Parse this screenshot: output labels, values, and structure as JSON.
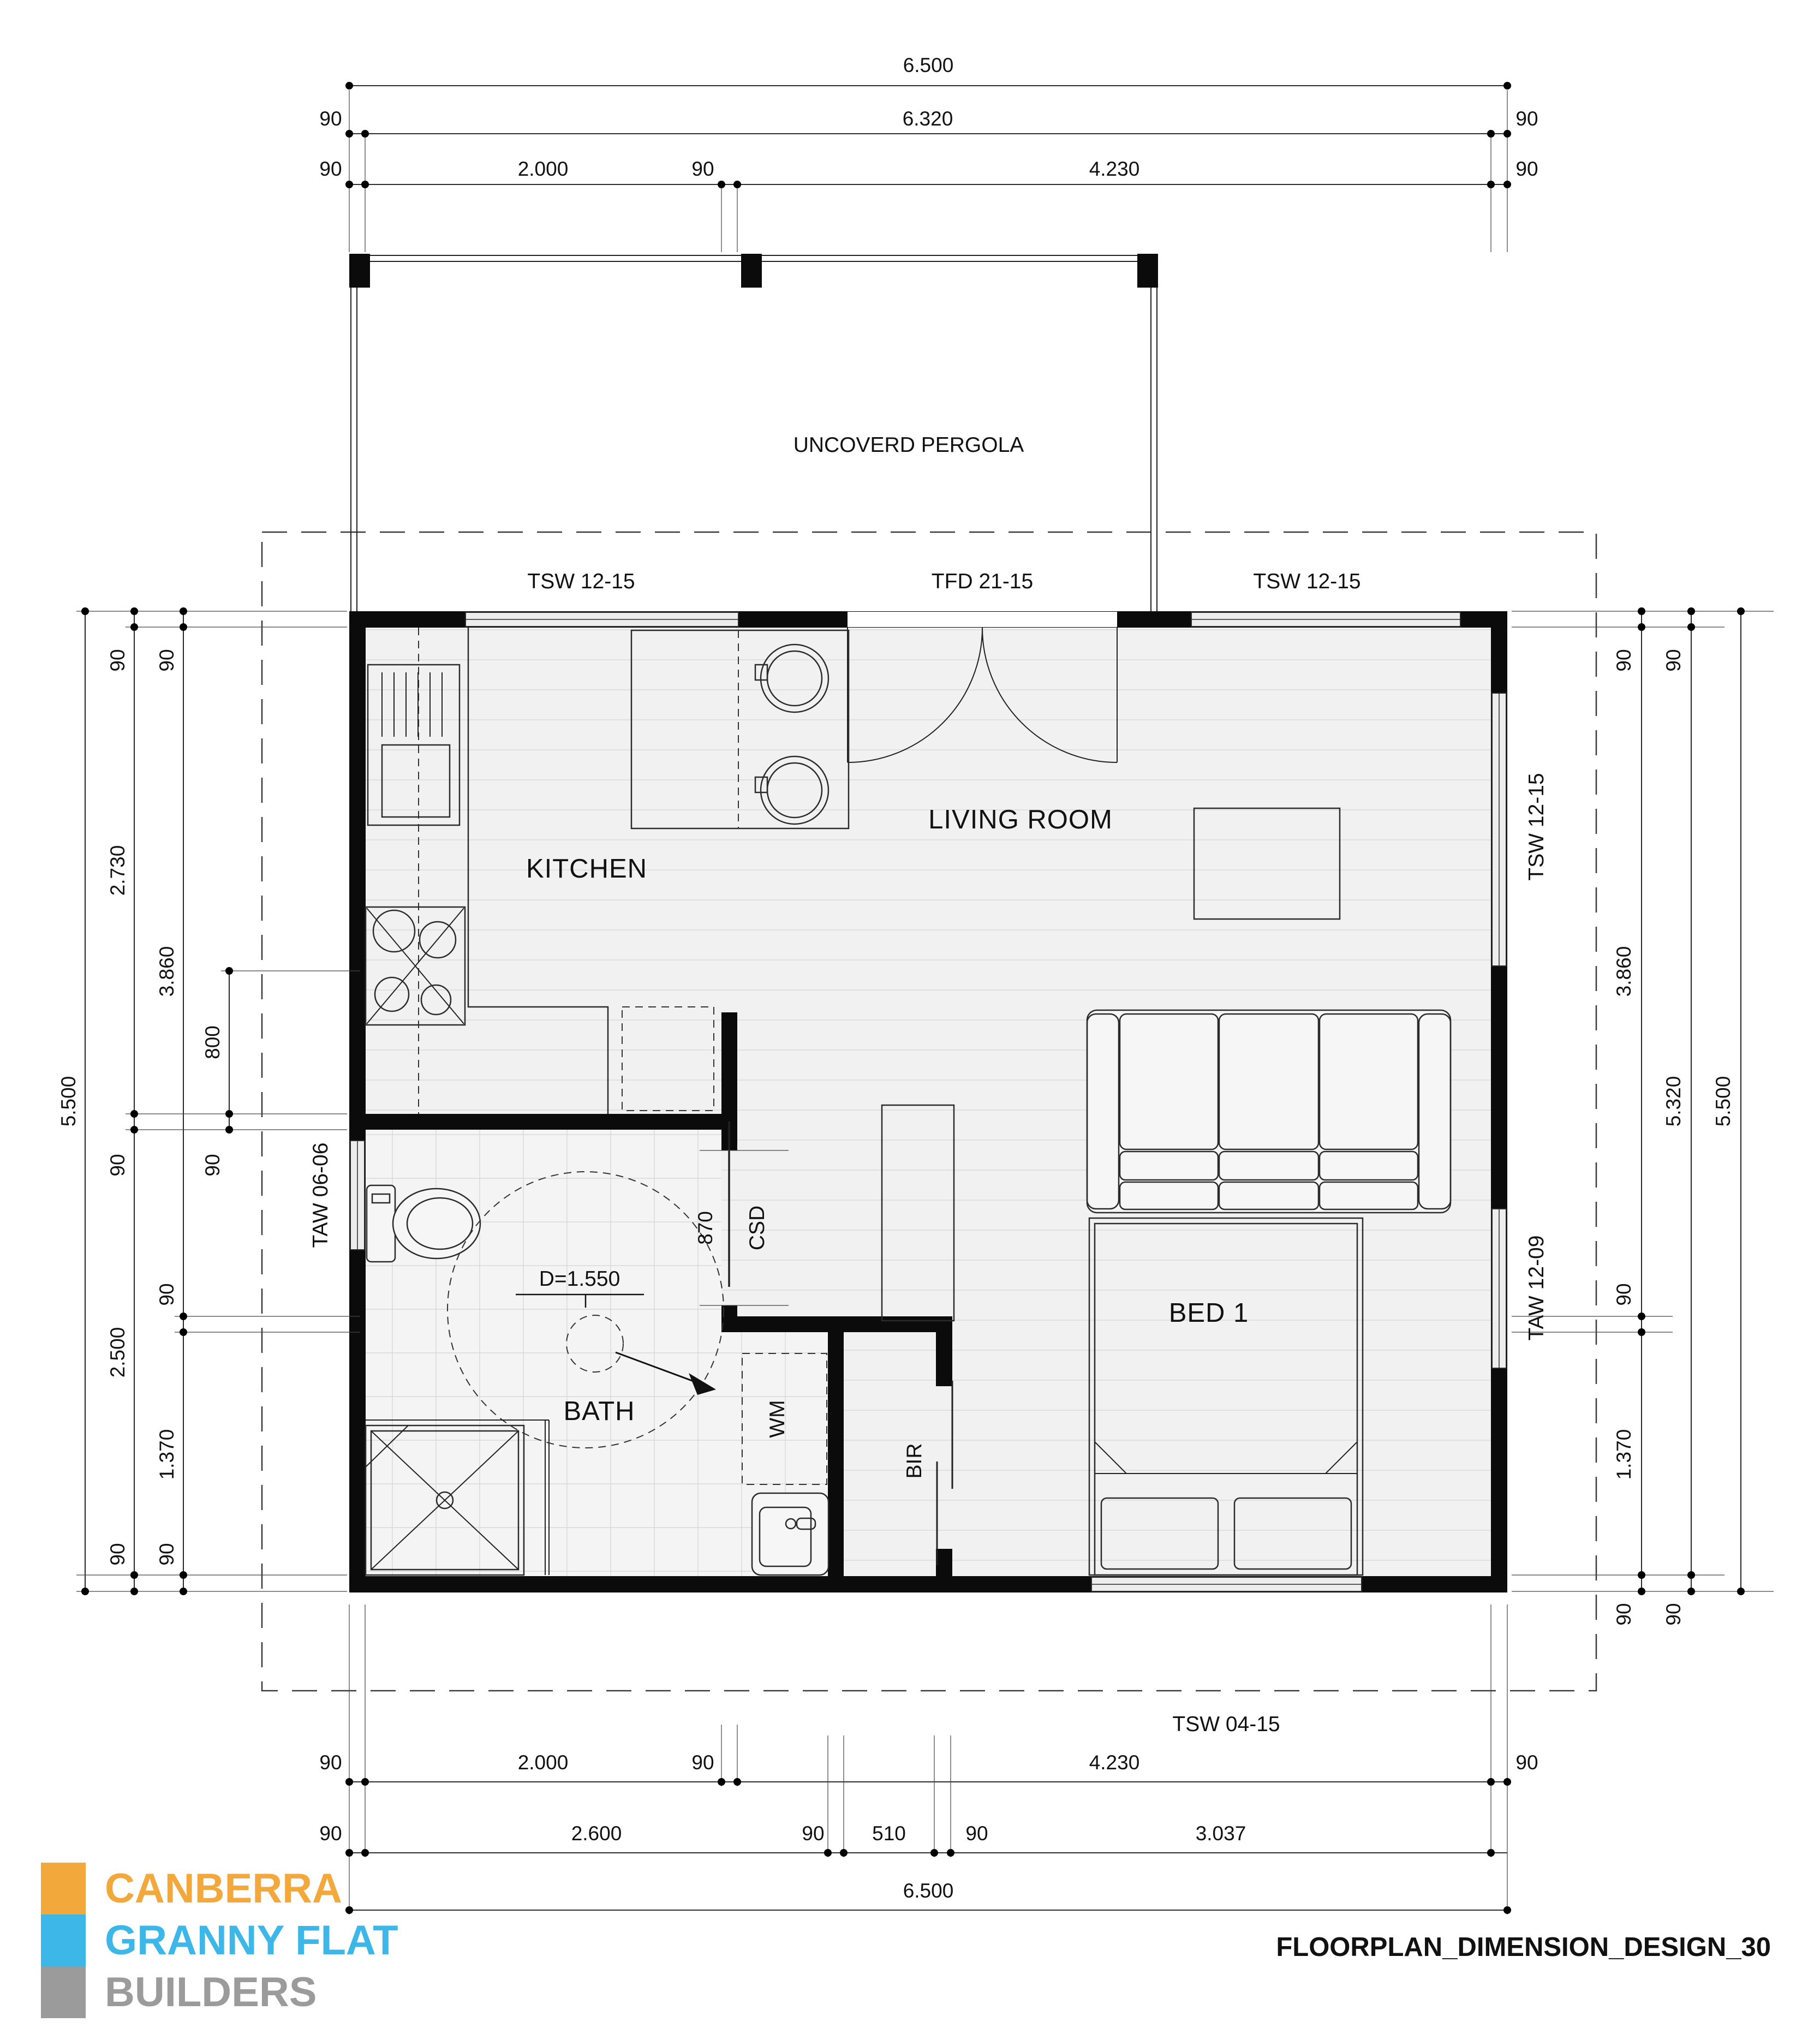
{
  "title_block": "FLOORPLAN_DIMENSION_DESIGN_30",
  "logo": {
    "line1": "CANBERRA",
    "line2": "GRANNY FLAT",
    "line3": "BUILDERS",
    "orange": "#F2A83B",
    "blue": "#3CB7E8",
    "gray": "#9B9B9B"
  },
  "outdoor": {
    "pergola": "UNCOVERD PERGOLA"
  },
  "rooms": {
    "kitchen": "KITCHEN",
    "living": "LIVING ROOM",
    "bath": "BATH",
    "bed": "BED 1"
  },
  "fixtures": {
    "wm": "WM",
    "bir": "BIR",
    "csd": "CSD",
    "csd_opening": "870",
    "turning_circle": "D=1.550"
  },
  "windows": {
    "top_left": "TSW 12-15",
    "top_door": "TFD 21-15",
    "top_right": "TSW 12-15",
    "right_upper": "TSW 12-15",
    "right_lower": "TAW 12-09",
    "left": "TAW 06-06",
    "bottom": "TSW 04-15"
  },
  "dims": {
    "top": {
      "total": "6.500",
      "row2": [
        "90",
        "6.320",
        "90"
      ],
      "row3": [
        "90",
        "2.000",
        "90",
        "4.230",
        "90"
      ]
    },
    "bottom": {
      "row1": [
        "90",
        "2.000",
        "90",
        "4.230",
        "90"
      ],
      "row2": [
        "90",
        "2.600",
        "90",
        "510",
        "90",
        "3.037"
      ],
      "total": "6.500"
    },
    "left": {
      "total": "5.500",
      "chainA": [
        "90",
        "2.730",
        "90",
        "2.500",
        "90"
      ],
      "chainB": [
        "90",
        "3.860",
        "90",
        "1.370",
        "90"
      ],
      "chainC": [
        "800",
        "90"
      ]
    },
    "right": {
      "chainA": [
        "90",
        "3.860",
        "90",
        "1.370",
        "90"
      ],
      "chainB": [
        "90",
        "5.320",
        "90"
      ],
      "total": "5.500"
    }
  }
}
